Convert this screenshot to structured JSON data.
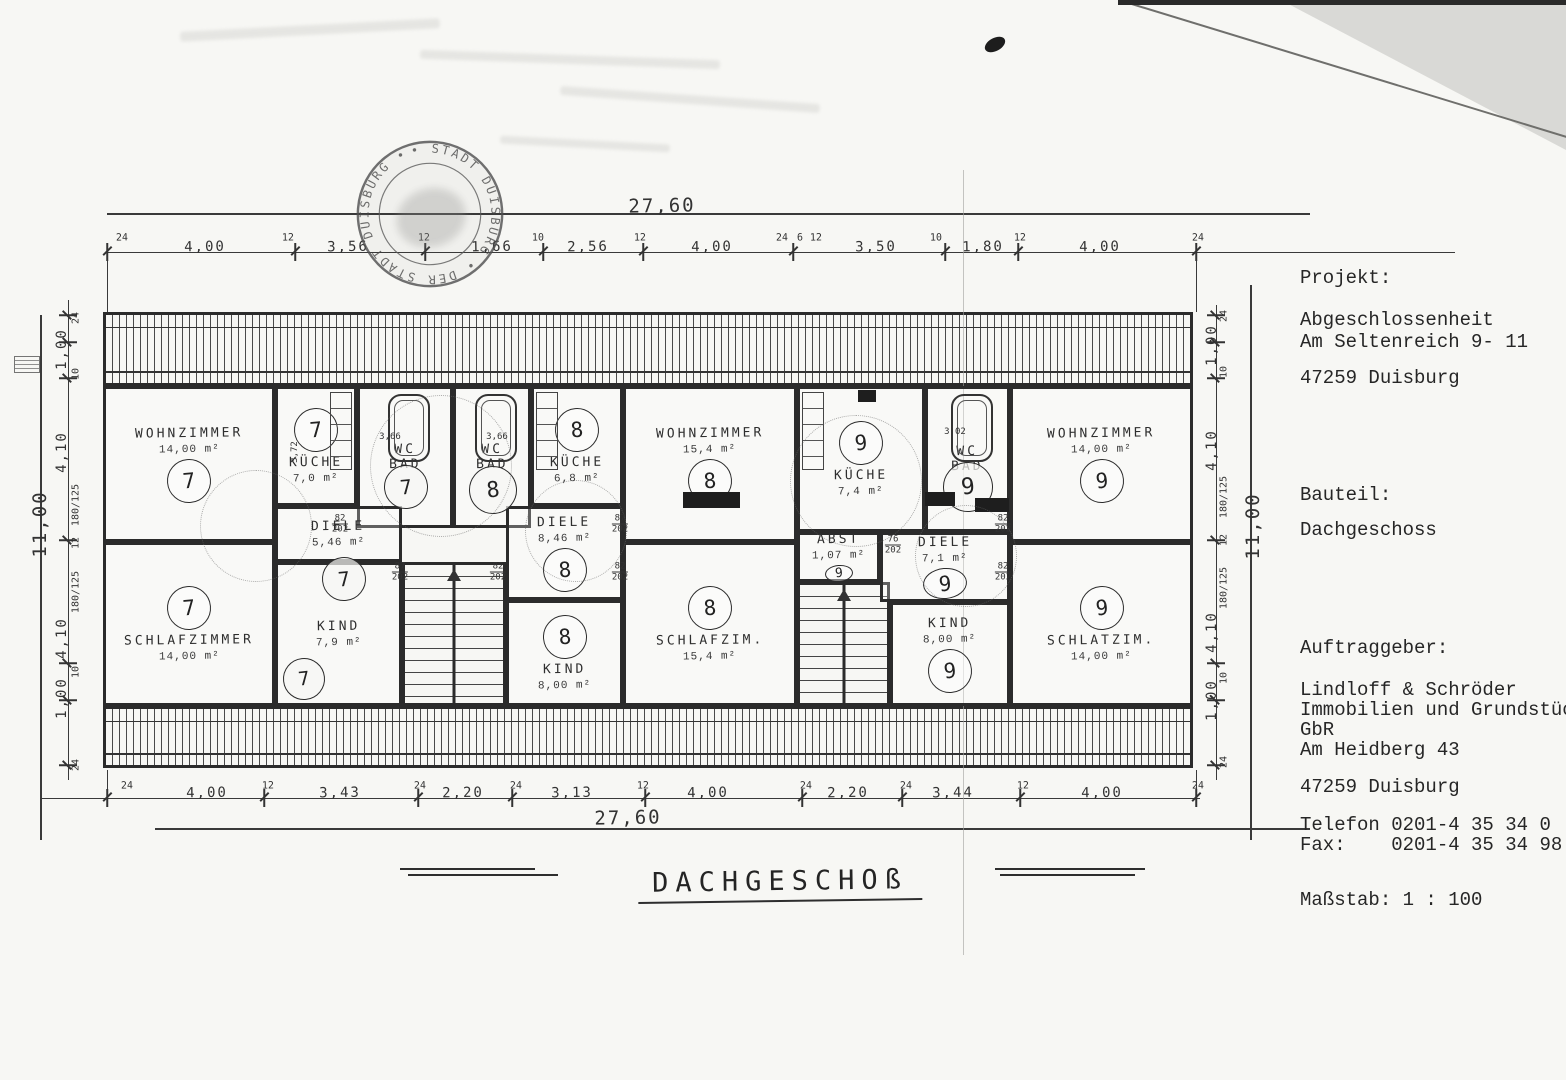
{
  "info_panel": {
    "projekt_label": "Projekt:",
    "projekt_line1": "Abgeschlossenheit",
    "projekt_line2": "Am Seltenreich 9- 11",
    "projekt_city": "47259 Duisburg",
    "bauteil_label": "Bauteil:",
    "bauteil_value": "Dachgeschoss",
    "auftraggeber_label": "Auftraggeber:",
    "auftraggeber_line1": "Lindloff & Schröder",
    "auftraggeber_line2": "Immobilien und Grundstücksha",
    "auftraggeber_line3": "GbR",
    "auftraggeber_line4": "Am Heidberg 43",
    "auftraggeber_city": "47259 Duisburg",
    "telefon": "Telefon 0201-4 35 34 0",
    "fax": "Fax:    0201-4 35 34 98",
    "massstab": "Maßstab: 1 : 100"
  },
  "plan": {
    "drawing_title": "DACHGESCHOß",
    "stamp_text": "• STADT DUISBURG • DER STADT DUISBURG •",
    "overall_top": "27,60",
    "overall_bottom": "27,60",
    "overall_left": "11,00",
    "overall_right": "11,00",
    "rooms": [
      {
        "id": "wohnzimmer-7",
        "name": "WOHNZIMMER",
        "area": "14,00 m²",
        "circle": "7",
        "cpos": "below",
        "x": 103,
        "y": 386,
        "w": 172,
        "h": 156
      },
      {
        "id": "schlafzimmer-7",
        "name": "SCHLAFZIMMER",
        "area": "14,00 m²",
        "circle": "7",
        "cpos": "above",
        "x": 103,
        "y": 542,
        "w": 172,
        "h": 164
      },
      {
        "id": "kueche-7",
        "name": "KÜCHE",
        "area": "7,0 m²",
        "circle": "7",
        "cpos": "above",
        "x": 275,
        "y": 386,
        "w": 82,
        "h": 120,
        "counter": "right"
      },
      {
        "id": "bad-7",
        "name": "WC\nBAD",
        "cpos": "none",
        "x": 357,
        "y": 386,
        "w": 96,
        "h": 142,
        "type": "bad"
      },
      {
        "id": "diele-7",
        "name": "DIELE",
        "area": "5,46 m²",
        "cpos": "none",
        "x": 275,
        "y": 506,
        "w": 127,
        "h": 56
      },
      {
        "id": "kind-7",
        "name": "KIND",
        "area": "7,9 m²",
        "cpos": "none",
        "x": 275,
        "y": 562,
        "w": 127,
        "h": 144
      },
      {
        "id": "treppe-1",
        "name": "",
        "cpos": "none",
        "x": 402,
        "y": 562,
        "w": 104,
        "h": 144,
        "type": "stair"
      },
      {
        "id": "bad-8",
        "name": "WC\nBAD",
        "cpos": "none",
        "x": 453,
        "y": 386,
        "w": 78,
        "h": 142,
        "type": "bad"
      },
      {
        "id": "kueche-8",
        "name": "KÜCHE",
        "area": "6,8 m²",
        "circle": "8",
        "cpos": "above",
        "x": 531,
        "y": 386,
        "w": 92,
        "h": 120,
        "counter": "left"
      },
      {
        "id": "wohnzimmer-8",
        "name": "WOHNZIMMER",
        "area": "15,4 m²",
        "circle": "8",
        "cpos": "below",
        "x": 623,
        "y": 386,
        "w": 174,
        "h": 156
      },
      {
        "id": "diele-8",
        "name": "DIELE",
        "area": "8,46 m²",
        "circle": "8",
        "cpos": "below",
        "x": 506,
        "y": 506,
        "w": 117,
        "h": 94
      },
      {
        "id": "kind-8",
        "name": "KIND",
        "area": "8,00 m²",
        "circle": "8",
        "cpos": "above",
        "x": 506,
        "y": 600,
        "w": 117,
        "h": 106
      },
      {
        "id": "schlafzim-8",
        "name": "SCHLAFZIM.",
        "area": "15,4 m²",
        "circle": "8",
        "cpos": "above",
        "x": 623,
        "y": 542,
        "w": 174,
        "h": 164
      },
      {
        "id": "kueche-9",
        "name": "KÜCHE",
        "area": "7,4 m²",
        "circle": "9",
        "cpos": "above",
        "x": 797,
        "y": 386,
        "w": 128,
        "h": 146,
        "counter": "left"
      },
      {
        "id": "bad-9",
        "name": "WC\nBAD",
        "cpos": "none",
        "x": 925,
        "y": 386,
        "w": 85,
        "h": 146,
        "type": "bad"
      },
      {
        "id": "abst-9",
        "name": "ABST",
        "area": "1,07 m²",
        "circle": "9",
        "cpos": "below",
        "csmall": true,
        "x": 797,
        "y": 532,
        "w": 83,
        "h": 50
      },
      {
        "id": "treppe-2",
        "name": "",
        "cpos": "none",
        "x": 797,
        "y": 582,
        "w": 93,
        "h": 124,
        "type": "stair"
      },
      {
        "id": "diele-9",
        "name": "DIELE",
        "area": "7,1 m²",
        "circle": "9",
        "cpos": "below",
        "x": 880,
        "y": 532,
        "w": 130,
        "h": 70
      },
      {
        "id": "kind-9",
        "name": "KIND",
        "area": "8,00 m²",
        "circle": "9",
        "cpos": "below",
        "x": 890,
        "y": 602,
        "w": 120,
        "h": 104
      },
      {
        "id": "wohnzimmer-9",
        "name": "WOHNZIMMER",
        "area": "14,00 m²",
        "circle": "9",
        "cpos": "below",
        "x": 1010,
        "y": 386,
        "w": 183,
        "h": 156
      },
      {
        "id": "schlatzim-9",
        "name": "SCHLATZIM.",
        "area": "14,00 m²",
        "circle": "9",
        "cpos": "above",
        "x": 1010,
        "y": 542,
        "w": 183,
        "h": 164
      }
    ],
    "extra_circles": [
      {
        "n": "7",
        "x": 405,
        "y": 486,
        "r": 21
      },
      {
        "n": "8",
        "x": 492,
        "y": 489,
        "r": 23
      },
      {
        "n": "9",
        "x": 967,
        "y": 486,
        "r": 24
      },
      {
        "n": "7",
        "x": 343,
        "y": 578,
        "r": 21
      },
      {
        "n": "7",
        "x": 303,
        "y": 678,
        "r": 20
      }
    ],
    "top_dims": [
      {
        "t": "24",
        "x": 122,
        "sm": true
      },
      {
        "t": "4,00",
        "x": 205
      },
      {
        "t": "12",
        "x": 288,
        "sm": true
      },
      {
        "t": "3,56",
        "x": 348
      },
      {
        "t": "12",
        "x": 424,
        "sm": true
      },
      {
        "t": "1,66",
        "x": 492
      },
      {
        "t": "10",
        "x": 538,
        "sm": true
      },
      {
        "t": "2,56",
        "x": 588
      },
      {
        "t": "12",
        "x": 640,
        "sm": true
      },
      {
        "t": "4,00",
        "x": 712
      },
      {
        "t": "24",
        "x": 782,
        "sm": true
      },
      {
        "t": "6",
        "x": 800,
        "sm": true
      },
      {
        "t": "12",
        "x": 816,
        "sm": true
      },
      {
        "t": "3,50",
        "x": 876
      },
      {
        "t": "10",
        "x": 936,
        "sm": true
      },
      {
        "t": "1,80",
        "x": 983
      },
      {
        "t": "12",
        "x": 1020,
        "sm": true
      },
      {
        "t": "4,00",
        "x": 1100
      },
      {
        "t": "24",
        "x": 1198,
        "sm": true
      }
    ],
    "bottom_dims": [
      {
        "t": "24",
        "x": 127,
        "sm": true
      },
      {
        "t": "4,00",
        "x": 207
      },
      {
        "t": "12",
        "x": 268,
        "sm": true
      },
      {
        "t": "3,43",
        "x": 340
      },
      {
        "t": "24",
        "x": 420,
        "sm": true
      },
      {
        "t": "2,20",
        "x": 463
      },
      {
        "t": "24",
        "x": 516,
        "sm": true
      },
      {
        "t": "3,13",
        "x": 572
      },
      {
        "t": "12",
        "x": 643,
        "sm": true
      },
      {
        "t": "4,00",
        "x": 708
      },
      {
        "t": "24",
        "x": 806,
        "sm": true
      },
      {
        "t": "2,20",
        "x": 848
      },
      {
        "t": "24",
        "x": 906,
        "sm": true
      },
      {
        "t": "3,44",
        "x": 953
      },
      {
        "t": "12",
        "x": 1023,
        "sm": true
      },
      {
        "t": "4,00",
        "x": 1102
      },
      {
        "t": "24",
        "x": 1198,
        "sm": true
      }
    ],
    "left_dims": [
      {
        "t": "24",
        "y": 318,
        "sm": true
      },
      {
        "t": "1,00",
        "y": 349
      },
      {
        "t": "10",
        "y": 374,
        "sm": true
      },
      {
        "t": "4,10",
        "y": 452
      },
      {
        "t": "180/125",
        "y": 505,
        "sm": true
      },
      {
        "t": "12",
        "y": 543,
        "sm": true
      },
      {
        "t": "180/125",
        "y": 592,
        "sm": true
      },
      {
        "t": "4,10",
        "y": 638
      },
      {
        "t": "10",
        "y": 672,
        "sm": true
      },
      {
        "t": "1,00",
        "y": 698
      },
      {
        "t": "24",
        "y": 765,
        "sm": true
      }
    ],
    "right_dims": [
      {
        "t": "24",
        "y": 316,
        "sm": true
      },
      {
        "t": "1,00",
        "y": 345
      },
      {
        "t": "10",
        "y": 372,
        "sm": true
      },
      {
        "t": "4,10",
        "y": 450
      },
      {
        "t": "180/125",
        "y": 497,
        "sm": true
      },
      {
        "t": "12",
        "y": 540,
        "sm": true
      },
      {
        "t": "180/125",
        "y": 588,
        "sm": true
      },
      {
        "t": "4,10",
        "y": 632
      },
      {
        "t": "10",
        "y": 678,
        "sm": true
      },
      {
        "t": "1,00",
        "y": 700
      },
      {
        "t": "24",
        "y": 762,
        "sm": true
      }
    ],
    "door_labels": [
      {
        "t": "82",
        "b": "202",
        "x": 340,
        "y": 524
      },
      {
        "t": "87",
        "b": "202",
        "x": 400,
        "y": 572
      },
      {
        "t": "82",
        "b": "202",
        "x": 498,
        "y": 572
      },
      {
        "t": "87",
        "b": "202",
        "x": 620,
        "y": 524
      },
      {
        "t": "82",
        "b": "202",
        "x": 620,
        "y": 572
      },
      {
        "t": "76",
        "b": "202",
        "x": 893,
        "y": 545
      },
      {
        "t": "82",
        "b": "202",
        "x": 1003,
        "y": 524
      },
      {
        "t": "82",
        "b": "202",
        "x": 1003,
        "y": 572
      }
    ],
    "misc_labels": [
      {
        "t": "3,66",
        "x": 390,
        "y": 437,
        "fs": 9
      },
      {
        "t": "3,66",
        "x": 497,
        "y": 437,
        "fs": 9
      },
      {
        "t": "3,02",
        "x": 955,
        "y": 432,
        "fs": 9
      },
      {
        "t": "3,72",
        "x": 295,
        "y": 452,
        "fs": 9,
        "rot": -90
      }
    ]
  }
}
